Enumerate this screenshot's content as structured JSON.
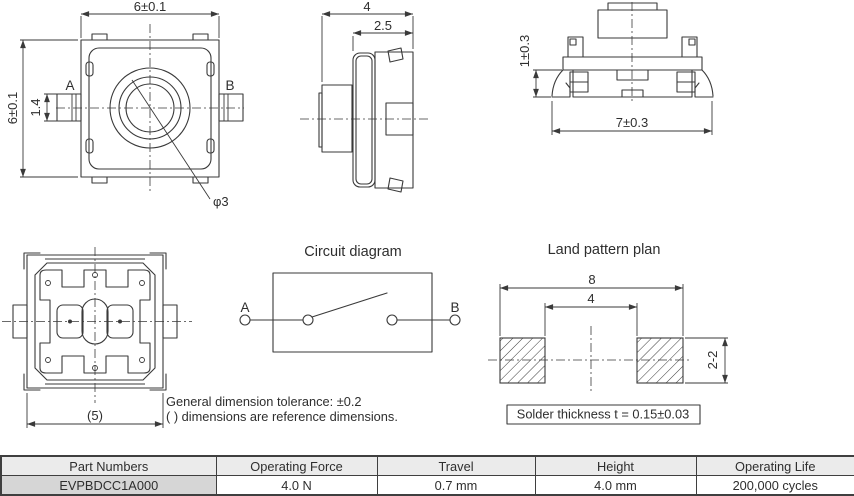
{
  "drawing": {
    "top_view": {
      "dim_width": "6±0.1",
      "dim_height": "6±0.1",
      "dim_terminal": "1.4",
      "terminal_a": "A",
      "terminal_b": "B",
      "dim_diameter": "φ3"
    },
    "side_view": {
      "dim_depth": "4",
      "dim_body_depth": "2.5"
    },
    "front_view": {
      "dim_leg_height": "1±0.3",
      "dim_total_width": "7±0.3"
    },
    "bottom_view": {
      "dim_width_ref": "(5)"
    },
    "circuit": {
      "title": "Circuit diagram",
      "terminal_a": "A",
      "terminal_b": "B"
    },
    "land_pattern": {
      "title": "Land pattern plan",
      "dim_outer": "8",
      "dim_inner": "4",
      "dim_pad": "2-2",
      "solder_note": "Solder thickness t = 0.15±0.03"
    }
  },
  "notes": {
    "tolerance": "General dimension tolerance: ±0.2",
    "reference": "( ) dimensions are reference dimensions."
  },
  "table": {
    "headers": [
      "Part Numbers",
      "Operating Force",
      "Travel",
      "Height",
      "Operating Life"
    ],
    "rows": [
      [
        "EVPBDCC1A000",
        "4.0 N",
        "0.7 mm",
        "4.0 mm",
        "200,000 cycles"
      ]
    ]
  },
  "colors": {
    "line": "#3a3a3a",
    "table_header_bg": "#ebebeb",
    "part_cell_bg": "#d6d6d6",
    "table_border": "#3f3f3f"
  }
}
